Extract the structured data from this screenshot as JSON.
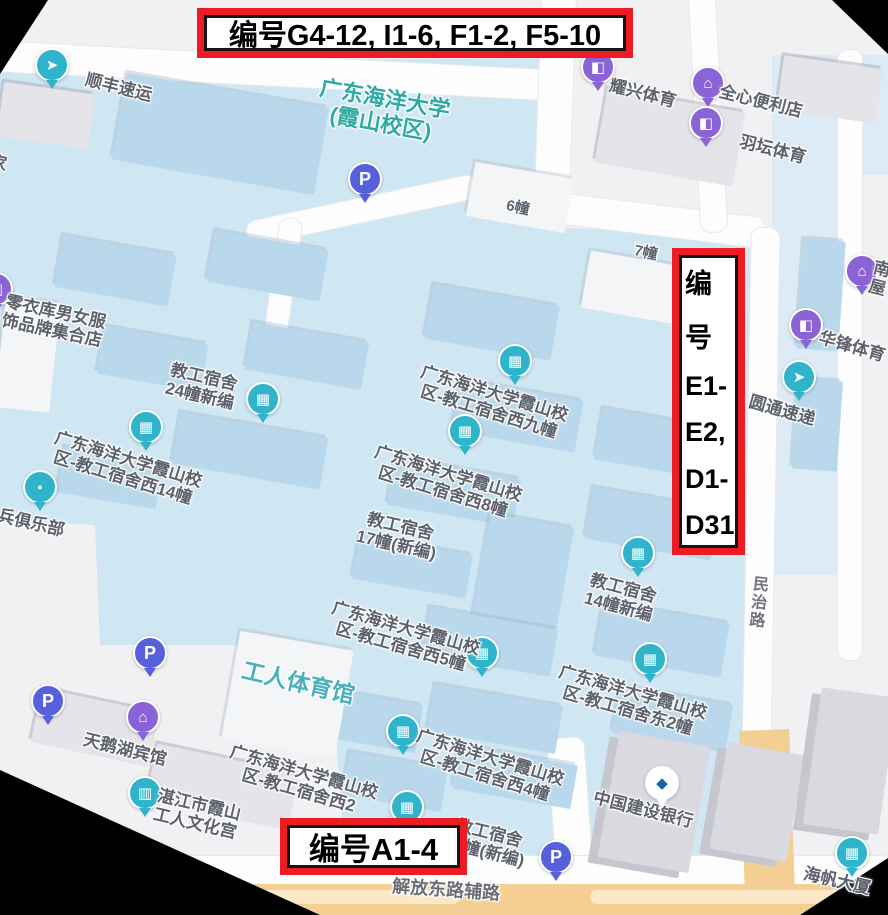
{
  "annotations": {
    "top_box_text": "编号G4-12, I1-6, F1-2, F5-10",
    "right_box_lines": [
      "编",
      "号",
      "E1-",
      "E2,",
      "D1-",
      "D31"
    ],
    "bottom_box_text": "编号A1-4"
  },
  "colors": {
    "annotation_red": "#ed1c24",
    "campus_fill": "#cfe6f3",
    "building_blue": "#b9d8ec",
    "poi_teal": "#2fb4cb",
    "poi_purple": "#8a63d6",
    "parking_blue": "#5660dc",
    "campus_title_teal": "#2fa9a4",
    "gym_teal": "#4ab0bc",
    "road_orange": "#f3cf93"
  },
  "map": {
    "pin_glyphs": {
      "building": "▦",
      "bag": "◧",
      "store": "⌂",
      "courier": "➤",
      "hotel": "⌂",
      "bank": "◆",
      "culture": "▥",
      "dot": "●",
      "parking": "P"
    },
    "pin_colors": {
      "building": "#2fb4cb",
      "bag": "#8a63d6",
      "store": "#8a63d6",
      "courier": "#2fb4cb",
      "hotel": "#8a63d6",
      "bank": "#ffffff",
      "culture": "#2fb4cb",
      "dot": "#2fb4cb",
      "parking": "#5660dc"
    },
    "labels": [
      {
        "name": "poi-sf-express",
        "lines": [
          "顺丰速运"
        ],
        "x": 88,
        "y": 70,
        "rot": 14,
        "interactable": true,
        "pin": {
          "type": "courier",
          "x": 52,
          "y": 78
        }
      },
      {
        "name": "campus-title",
        "lines": [
          "广东海洋大学",
          "(霞山校区)"
        ],
        "x": 322,
        "y": 76,
        "rot": 10,
        "size": 22,
        "color": "#2fa9a4",
        "interactable": true
      },
      {
        "name": "poi-yaoxing-sports",
        "lines": [
          "耀兴体育"
        ],
        "x": 612,
        "y": 76,
        "rot": 14,
        "interactable": true,
        "pin": {
          "type": "bag",
          "x": 598,
          "y": 80
        }
      },
      {
        "name": "poi-quanxin-store",
        "lines": [
          "全心便利店"
        ],
        "x": 722,
        "y": 82,
        "rot": 14,
        "interactable": true,
        "pin": {
          "type": "store",
          "x": 708,
          "y": 96
        }
      },
      {
        "name": "poi-yutan-sports",
        "lines": [
          "羽坛体育"
        ],
        "x": 742,
        "y": 132,
        "rot": 14,
        "interactable": true,
        "pin": {
          "type": "bag",
          "x": 706,
          "y": 136
        }
      },
      {
        "name": "label-building-6",
        "lines": [
          "6幢"
        ],
        "x": 508,
        "y": 198,
        "rot": 12,
        "size": 15,
        "interactable": false
      },
      {
        "name": "label-building-7",
        "lines": [
          "7幢"
        ],
        "x": 636,
        "y": 243,
        "rot": 12,
        "size": 15,
        "interactable": false
      },
      {
        "name": "poi-lingyiku-clothing",
        "lines": [
          "零衣库男女服",
          "饰品牌集合店"
        ],
        "x": 8,
        "y": 292,
        "rot": 12,
        "interactable": true,
        "pin": {
          "type": "bag",
          "x": -4,
          "y": 302
        }
      },
      {
        "name": "poi-dorm-24",
        "lines": [
          "教工宿舍",
          "24幢新编"
        ],
        "x": 172,
        "y": 360,
        "rot": 13,
        "interactable": true,
        "pin": {
          "type": "building",
          "x": 263,
          "y": 412
        }
      },
      {
        "name": "poi-dorm-west-9",
        "lines": [
          "广东海洋大学霞山校",
          "区-教工宿舍西九幢"
        ],
        "x": 424,
        "y": 362,
        "rot": 17,
        "interactable": true,
        "pin": {
          "type": "building",
          "x": 515,
          "y": 374
        }
      },
      {
        "name": "poi-dorm-west-14",
        "lines": [
          "广东海洋大学霞山校",
          "区-教工宿舍西14幢"
        ],
        "x": 58,
        "y": 428,
        "rot": 17,
        "interactable": true,
        "pin": {
          "type": "building",
          "x": 146,
          "y": 440
        }
      },
      {
        "name": "poi-huafeng-sports",
        "lines": [
          "华锋体育"
        ],
        "x": 822,
        "y": 328,
        "rot": 16,
        "interactable": true,
        "pin": {
          "type": "bag",
          "x": 806,
          "y": 338
        }
      },
      {
        "name": "poi-yto-express",
        "lines": [
          "圆通速递"
        ],
        "x": 752,
        "y": 392,
        "rot": 16,
        "interactable": true,
        "pin": {
          "type": "courier",
          "x": 799,
          "y": 390
        }
      },
      {
        "name": "poi-partial-right",
        "lines": [
          "南",
          "屋"
        ],
        "x": 876,
        "y": 258,
        "rot": 14,
        "interactable": false,
        "pin": {
          "type": "store",
          "x": 862,
          "y": 284
        }
      },
      {
        "name": "poi-veterans-club",
        "lines": [
          "兵俱乐部"
        ],
        "x": 0,
        "y": 506,
        "rot": 13,
        "interactable": true,
        "pin": {
          "type": "dot",
          "x": 40,
          "y": 500
        }
      },
      {
        "name": "poi-dorm-west-8",
        "lines": [
          "广东海洋大学霞山校",
          "区-教工宿舍西8幢"
        ],
        "x": 378,
        "y": 442,
        "rot": 17,
        "interactable": true,
        "pin": {
          "type": "building",
          "x": 465,
          "y": 444
        }
      },
      {
        "name": "label-dorm-17",
        "lines": [
          "教工宿舍",
          "17幢(新编)"
        ],
        "x": 363,
        "y": 508,
        "rot": 13,
        "interactable": false
      },
      {
        "name": "poi-dorm-14-new",
        "lines": [
          "教工宿舍",
          "14幢新编"
        ],
        "x": 592,
        "y": 570,
        "rot": 15,
        "interactable": true,
        "pin": {
          "type": "building",
          "x": 638,
          "y": 566
        }
      },
      {
        "name": "label-minzhi-road",
        "lines": [
          "民",
          "治",
          "路"
        ],
        "x": 754,
        "y": 576,
        "rot": 6,
        "size": 16,
        "color": "#73737e",
        "interactable": false
      },
      {
        "name": "poi-dorm-west-5",
        "lines": [
          "广东海洋大学霞山校",
          "区-教工宿舍西5幢"
        ],
        "x": 335,
        "y": 598,
        "rot": 16,
        "interactable": true,
        "pin": {
          "type": "building",
          "x": 482,
          "y": 666
        }
      },
      {
        "name": "poi-workers-gym",
        "lines": [
          "工人体育馆"
        ],
        "x": 245,
        "y": 658,
        "rot": 13,
        "size": 23,
        "color": "#4ab0bc",
        "interactable": true
      },
      {
        "name": "poi-dorm-east-2",
        "lines": [
          "广东海洋大学霞山校",
          "区-教工宿舍东2幢"
        ],
        "x": 562,
        "y": 662,
        "rot": 16,
        "interactable": true,
        "pin": {
          "type": "building",
          "x": 650,
          "y": 672
        }
      },
      {
        "name": "poi-swan-lake-hotel",
        "lines": [
          "天鹅湖宾馆"
        ],
        "x": 86,
        "y": 730,
        "rot": 14,
        "interactable": true,
        "pin": {
          "type": "hotel",
          "x": 143,
          "y": 730
        }
      },
      {
        "name": "poi-dorm-west-2",
        "lines": [
          "广东海洋大学霞山校",
          "区-教工宿舍西2"
        ],
        "x": 233,
        "y": 742,
        "rot": 16,
        "interactable": true,
        "pin": {
          "type": "building",
          "x": 407,
          "y": 820
        }
      },
      {
        "name": "poi-dorm-west-4",
        "lines": [
          "广东海洋大学霞山校",
          "区-教工宿舍西4幢"
        ],
        "x": 420,
        "y": 726,
        "rot": 17,
        "interactable": true,
        "pin": {
          "type": "building",
          "x": 403,
          "y": 744
        }
      },
      {
        "name": "poi-culture-palace",
        "lines": [
          "湛江市霞山",
          "工人文化宫"
        ],
        "x": 160,
        "y": 786,
        "rot": 13,
        "interactable": true,
        "pin": {
          "type": "culture",
          "x": 145,
          "y": 806
        }
      },
      {
        "name": "poi-ccb-bank",
        "lines": [
          "中国建设银行"
        ],
        "x": 596,
        "y": 788,
        "rot": 14,
        "interactable": true,
        "pin": {
          "type": "bank",
          "x": 662,
          "y": 796
        }
      },
      {
        "name": "label-dorm-10",
        "lines": [
          "教工宿舍",
          "10幢(新编)"
        ],
        "x": 452,
        "y": 814,
        "rot": 14,
        "interactable": false
      },
      {
        "name": "label-jiefang-east-aux-road",
        "lines": [
          "解放东路辅路"
        ],
        "x": 393,
        "y": 876,
        "rot": 4,
        "size": 18,
        "color": "#6d6d78",
        "interactable": false
      },
      {
        "name": "poi-haifan-building",
        "lines": [
          "海帆大厦"
        ],
        "x": 806,
        "y": 864,
        "rot": 13,
        "interactable": true,
        "pin": {
          "type": "building",
          "x": 852,
          "y": 866
        }
      },
      {
        "name": "label-partial-left",
        "lines": [
          "家"
        ],
        "x": -8,
        "y": 152,
        "rot": 12,
        "interactable": false
      }
    ],
    "parking_pins": [
      {
        "name": "parking-pin-campus",
        "x": 365,
        "y": 192
      },
      {
        "name": "parking-pin-gym",
        "x": 150,
        "y": 666
      },
      {
        "name": "parking-pin-hotel",
        "x": 48,
        "y": 714
      },
      {
        "name": "parking-pin-south",
        "x": 556,
        "y": 870
      }
    ]
  }
}
